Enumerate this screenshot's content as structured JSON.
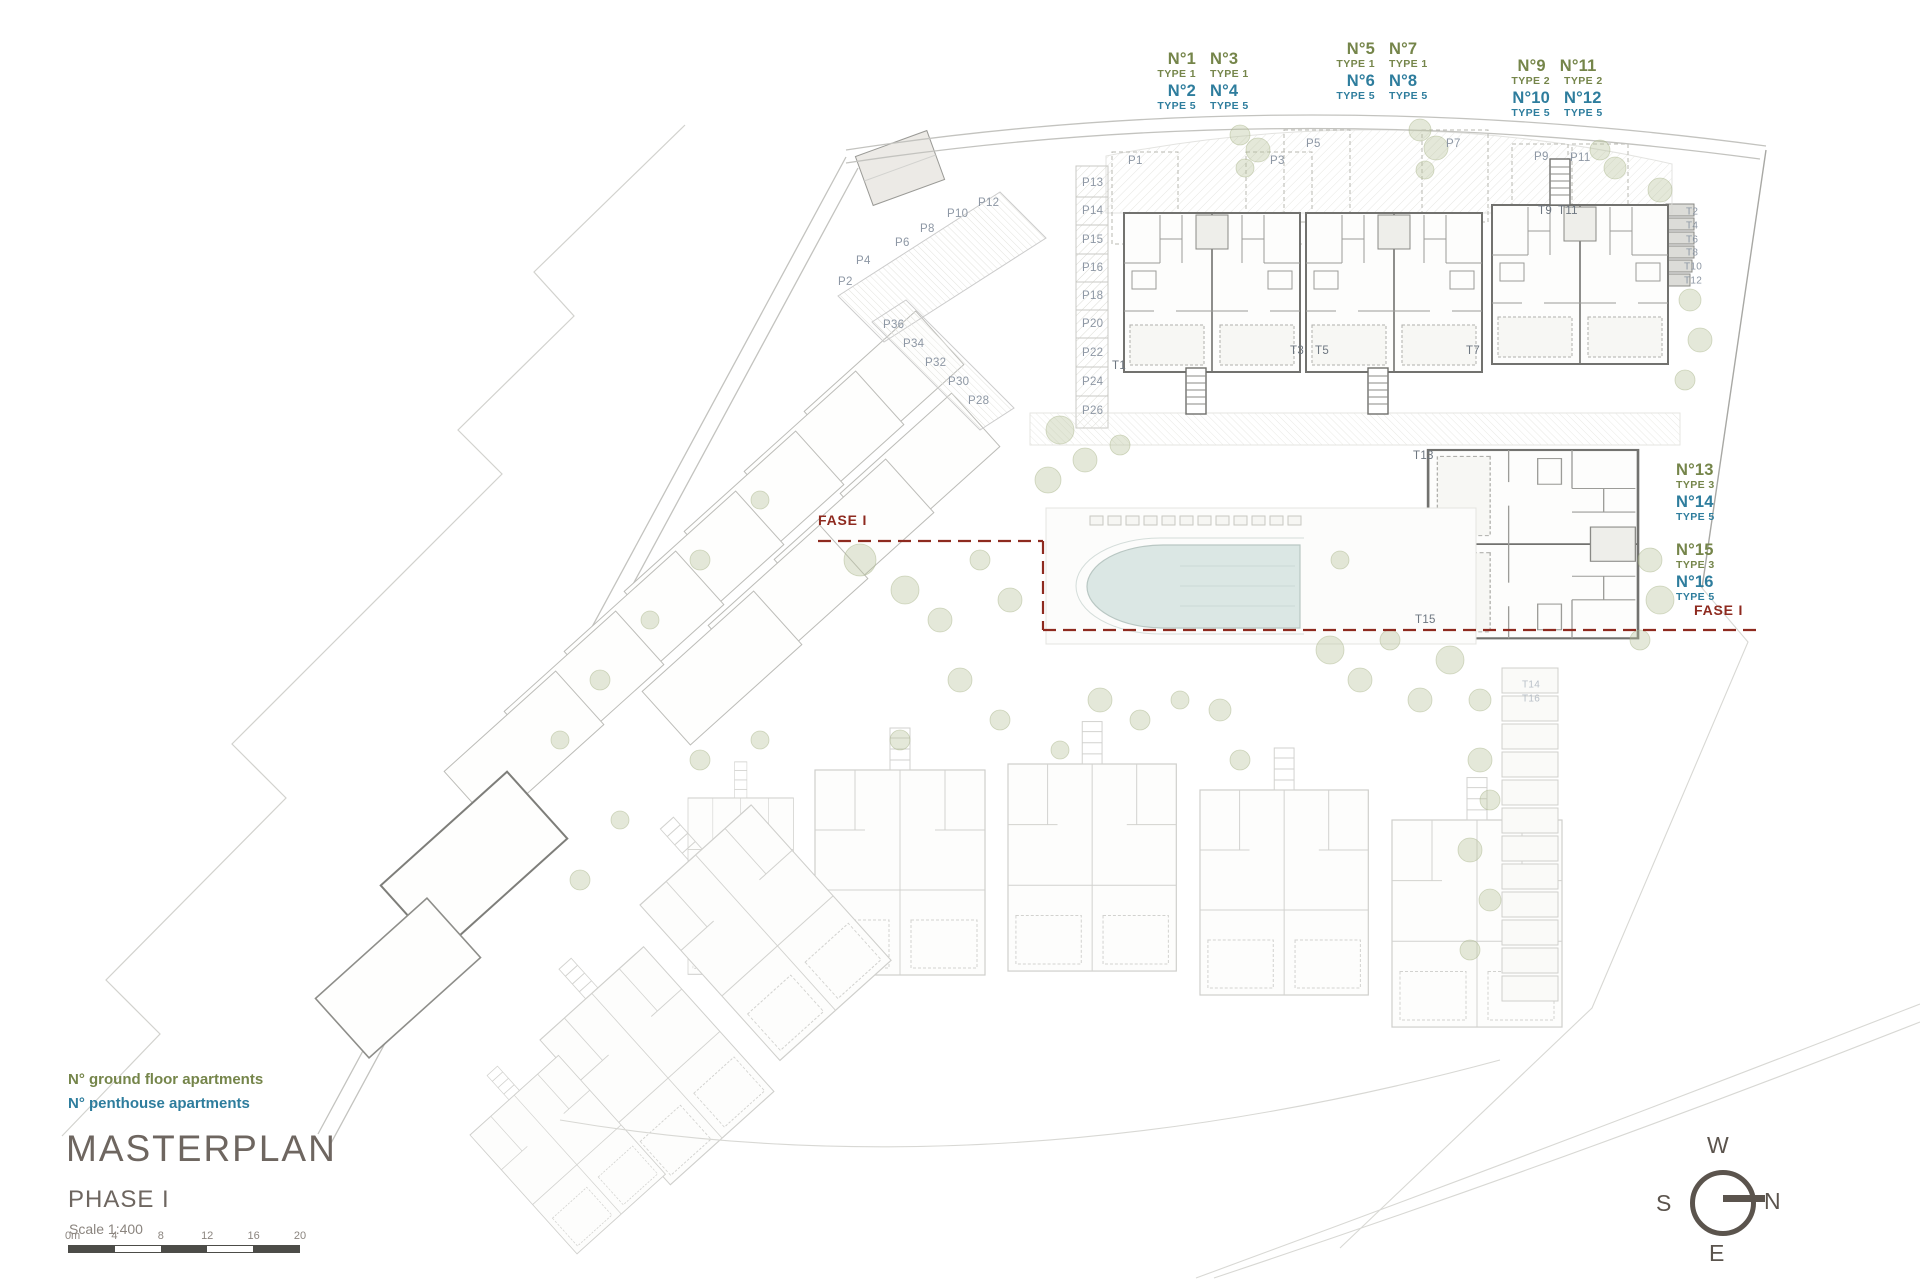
{
  "title_block": {
    "title": "MASTERPLAN",
    "phase": "PHASE I",
    "scale": "Scale 1:400"
  },
  "legend": {
    "ground_floor": "N° ground floor apartments",
    "penthouse": "N° penthouse apartments"
  },
  "fase_labels": {
    "left": "FASE I",
    "right": "FASE I"
  },
  "compass": {
    "top": "W",
    "right": "N",
    "bottom": "E",
    "left": "S"
  },
  "scale_bar": {
    "ticks": [
      "0m",
      "4",
      "8",
      "12",
      "16",
      "20"
    ]
  },
  "colors": {
    "ground": "#75854a",
    "penthouse": "#2e7d9d",
    "fase": "#8e2a1f",
    "title_gray": "#6e6660",
    "plan_gray": "#8d97a4",
    "pool_fill": "#dbe7e4",
    "tree_green": "#b9c29b"
  },
  "unit_label_groups": [
    {
      "name": "units-1-4",
      "x": 1203,
      "y": 49,
      "align": "center",
      "rows": [
        {
          "color": "ground",
          "size": "big",
          "cells": [
            "N°1",
            "N°3"
          ]
        },
        {
          "color": "ground",
          "size": "small",
          "cells": [
            "TYPE 1",
            "TYPE 1"
          ]
        },
        {
          "color": "penthouse",
          "size": "big",
          "cells": [
            "N°2",
            "N°4"
          ]
        },
        {
          "color": "penthouse",
          "size": "small",
          "cells": [
            "TYPE 5",
            "TYPE 5"
          ]
        }
      ]
    },
    {
      "name": "units-5-8",
      "x": 1382,
      "y": 39,
      "align": "center",
      "rows": [
        {
          "color": "ground",
          "size": "big",
          "cells": [
            "N°5",
            "N°7"
          ]
        },
        {
          "color": "ground",
          "size": "small",
          "cells": [
            "TYPE 1",
            "TYPE 1"
          ]
        },
        {
          "color": "penthouse",
          "size": "big",
          "cells": [
            "N°6",
            "N°8"
          ]
        },
        {
          "color": "penthouse",
          "size": "small",
          "cells": [
            "TYPE 5",
            "TYPE 5"
          ]
        }
      ]
    },
    {
      "name": "units-9-12",
      "x": 1557,
      "y": 56,
      "align": "center",
      "rows": [
        {
          "color": "ground",
          "size": "big",
          "cells": [
            "N°9",
            "N°11"
          ]
        },
        {
          "color": "ground",
          "size": "small",
          "cells": [
            "TYPE 2",
            "TYPE 2"
          ]
        },
        {
          "color": "penthouse",
          "size": "big",
          "cells": [
            "N°10",
            "N°12"
          ]
        },
        {
          "color": "penthouse",
          "size": "small",
          "cells": [
            "TYPE 5",
            "TYPE 5"
          ]
        }
      ]
    },
    {
      "name": "units-13-14",
      "x": 1676,
      "y": 460,
      "align": "left",
      "rows": [
        {
          "color": "ground",
          "size": "big",
          "cells": [
            "N°13"
          ]
        },
        {
          "color": "ground",
          "size": "small",
          "cells": [
            "TYPE 3"
          ]
        },
        {
          "color": "penthouse",
          "size": "big",
          "cells": [
            "N°14"
          ]
        },
        {
          "color": "penthouse",
          "size": "small",
          "cells": [
            "TYPE 5"
          ]
        }
      ]
    },
    {
      "name": "units-15-16",
      "x": 1676,
      "y": 540,
      "align": "left",
      "rows": [
        {
          "color": "ground",
          "size": "big",
          "cells": [
            "N°15"
          ]
        },
        {
          "color": "ground",
          "size": "small",
          "cells": [
            "TYPE 3"
          ]
        },
        {
          "color": "penthouse",
          "size": "big",
          "cells": [
            "N°16"
          ]
        },
        {
          "color": "penthouse",
          "size": "small",
          "cells": [
            "TYPE 5"
          ]
        }
      ]
    }
  ],
  "plan_labels": [
    {
      "text": "P1",
      "x": 1128,
      "y": 161
    },
    {
      "text": "P3",
      "x": 1270,
      "y": 161
    },
    {
      "text": "P5",
      "x": 1306,
      "y": 144
    },
    {
      "text": "P7",
      "x": 1446,
      "y": 144
    },
    {
      "text": "P9",
      "x": 1534,
      "y": 157
    },
    {
      "text": "P11",
      "x": 1570,
      "y": 158
    },
    {
      "text": "P13",
      "x": 1082,
      "y": 183
    },
    {
      "text": "P14",
      "x": 1082,
      "y": 211
    },
    {
      "text": "P15",
      "x": 1082,
      "y": 240
    },
    {
      "text": "P16",
      "x": 1082,
      "y": 268
    },
    {
      "text": "P18",
      "x": 1082,
      "y": 296
    },
    {
      "text": "P20",
      "x": 1082,
      "y": 324
    },
    {
      "text": "P22",
      "x": 1082,
      "y": 353
    },
    {
      "text": "P24",
      "x": 1082,
      "y": 382
    },
    {
      "text": "P26",
      "x": 1082,
      "y": 411
    },
    {
      "text": "P12",
      "x": 978,
      "y": 203
    },
    {
      "text": "P10",
      "x": 947,
      "y": 214
    },
    {
      "text": "P8",
      "x": 920,
      "y": 229
    },
    {
      "text": "P6",
      "x": 895,
      "y": 243
    },
    {
      "text": "P4",
      "x": 856,
      "y": 261
    },
    {
      "text": "P2",
      "x": 838,
      "y": 282
    },
    {
      "text": "P36",
      "x": 883,
      "y": 325
    },
    {
      "text": "P34",
      "x": 903,
      "y": 344
    },
    {
      "text": "P32",
      "x": 925,
      "y": 363
    },
    {
      "text": "P30",
      "x": 948,
      "y": 382
    },
    {
      "text": "P28",
      "x": 968,
      "y": 401
    },
    {
      "text": "T1",
      "x": 1112,
      "y": 366,
      "cls": "dark"
    },
    {
      "text": "T3",
      "x": 1290,
      "y": 351,
      "cls": "dark"
    },
    {
      "text": "T5",
      "x": 1315,
      "y": 351,
      "cls": "dark"
    },
    {
      "text": "T7",
      "x": 1466,
      "y": 351,
      "cls": "dark"
    },
    {
      "text": "T9",
      "x": 1538,
      "y": 211,
      "cls": "dark"
    },
    {
      "text": "T11",
      "x": 1558,
      "y": 211,
      "cls": "dark"
    },
    {
      "text": "T13",
      "x": 1413,
      "y": 456,
      "cls": "dark"
    },
    {
      "text": "T15",
      "x": 1415,
      "y": 620,
      "cls": "dark"
    },
    {
      "text": "T2",
      "x": 1686,
      "y": 212,
      "cls": "small"
    },
    {
      "text": "T4",
      "x": 1686,
      "y": 226,
      "cls": "small"
    },
    {
      "text": "T6",
      "x": 1686,
      "y": 240,
      "cls": "small"
    },
    {
      "text": "T8",
      "x": 1686,
      "y": 253,
      "cls": "small"
    },
    {
      "text": "T10",
      "x": 1684,
      "y": 267,
      "cls": "small"
    },
    {
      "text": "T12",
      "x": 1684,
      "y": 281,
      "cls": "small"
    },
    {
      "text": "T14",
      "x": 1522,
      "y": 685,
      "cls": "muted small"
    },
    {
      "text": "T16",
      "x": 1522,
      "y": 699,
      "cls": "muted small"
    }
  ]
}
